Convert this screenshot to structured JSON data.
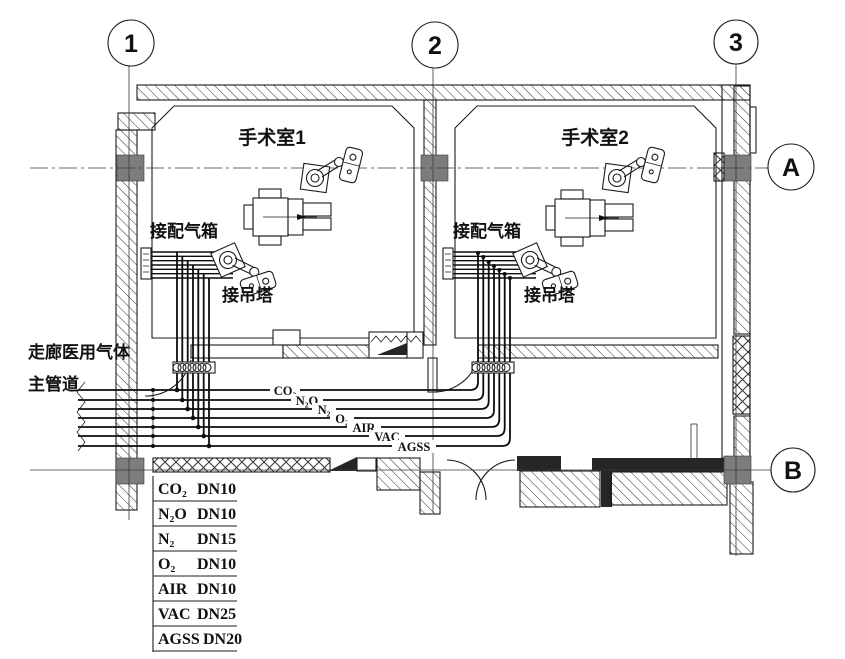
{
  "drawing": {
    "grid": {
      "cols": [
        {
          "label": "1"
        },
        {
          "label": "2"
        },
        {
          "label": "3"
        }
      ],
      "rows": [
        {
          "label": "A"
        },
        {
          "label": "B"
        }
      ]
    },
    "rooms": [
      {
        "name": "手术室1"
      },
      {
        "name": "手术室2"
      }
    ],
    "labels": {
      "gas_box": "接配气箱",
      "pendant_conn": "接吊塔",
      "corridor_line1": "走廊医用气体",
      "corridor_line2": "主管道"
    },
    "pipes": [
      {
        "label": "CO₂",
        "dn": "DN10"
      },
      {
        "label": "N₂O",
        "dn": "DN10"
      },
      {
        "label": "N₂",
        "dn": "DN15"
      },
      {
        "label": "O₂",
        "dn": "DN10"
      },
      {
        "label": "AIR",
        "dn": "DN10"
      },
      {
        "label": "VAC",
        "dn": "DN25"
      },
      {
        "label": "AGSS",
        "dn": "DN20"
      }
    ],
    "colors": {
      "line": "#1c1c1c",
      "column": "#7d7d7d",
      "black_wall": "#262626",
      "background": "#ffffff"
    }
  }
}
